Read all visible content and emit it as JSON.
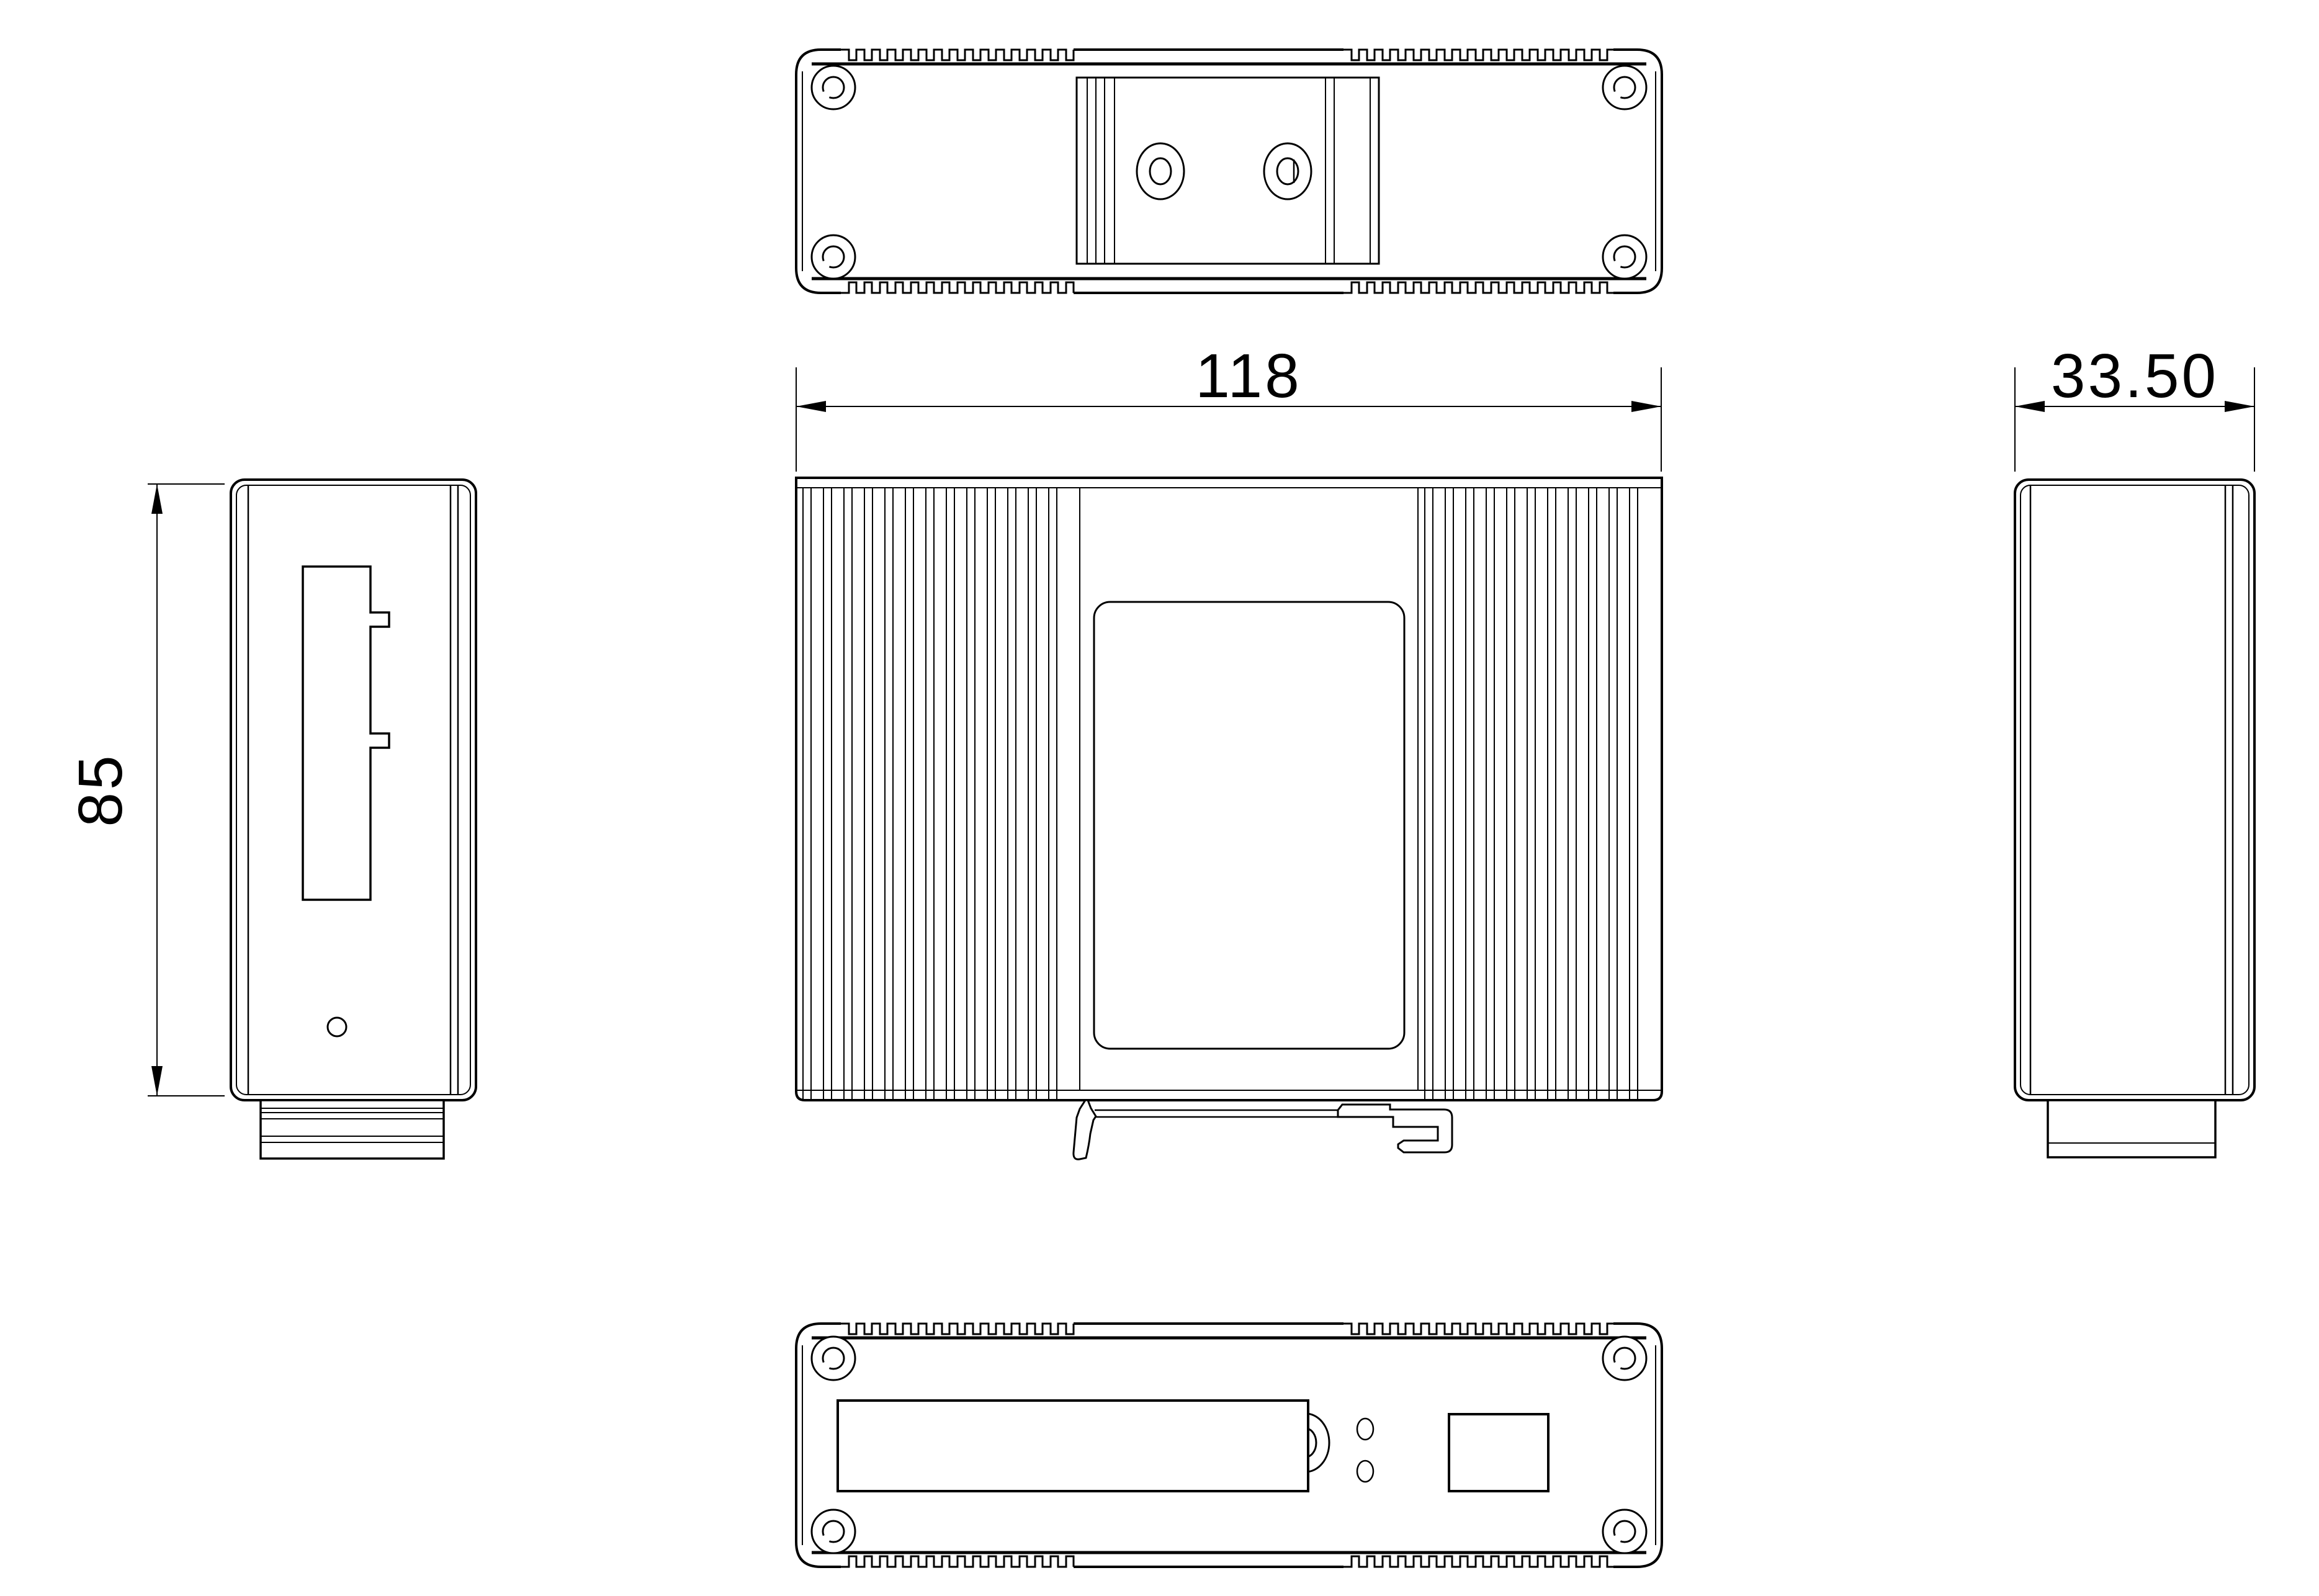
{
  "drawing": {
    "background": "#ffffff",
    "line_color": "#000000",
    "dimensions": {
      "width": "118",
      "depth": "33.50",
      "height": "85"
    }
  }
}
